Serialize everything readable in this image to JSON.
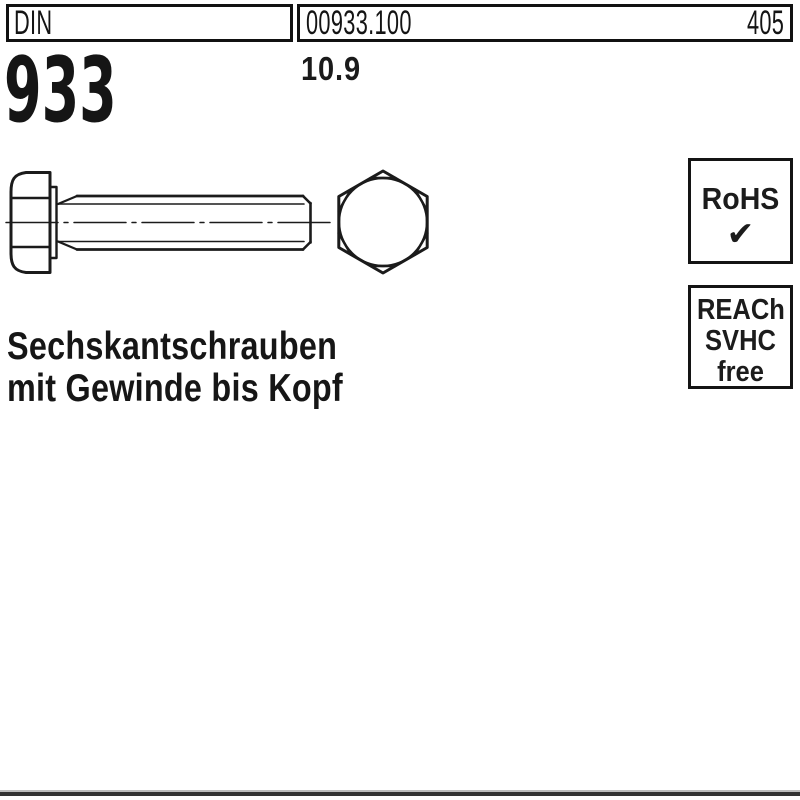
{
  "header": {
    "din_label": "DIN",
    "article_number": "00933.100",
    "catalog_page": "405"
  },
  "product": {
    "standard_number": "933",
    "strength_class": "10.9",
    "title_line1": "Sechskantschrauben",
    "title_line2": "mit Gewinde bis Kopf"
  },
  "badges": {
    "rohs": {
      "label": "RoHS",
      "check": "✔"
    },
    "reach": {
      "line1": "REACh",
      "line2": "SVHC",
      "line3": "free"
    }
  },
  "colors": {
    "line": "#1b1b1b",
    "background": "#ffffff",
    "bottom_bar": "#333333"
  }
}
